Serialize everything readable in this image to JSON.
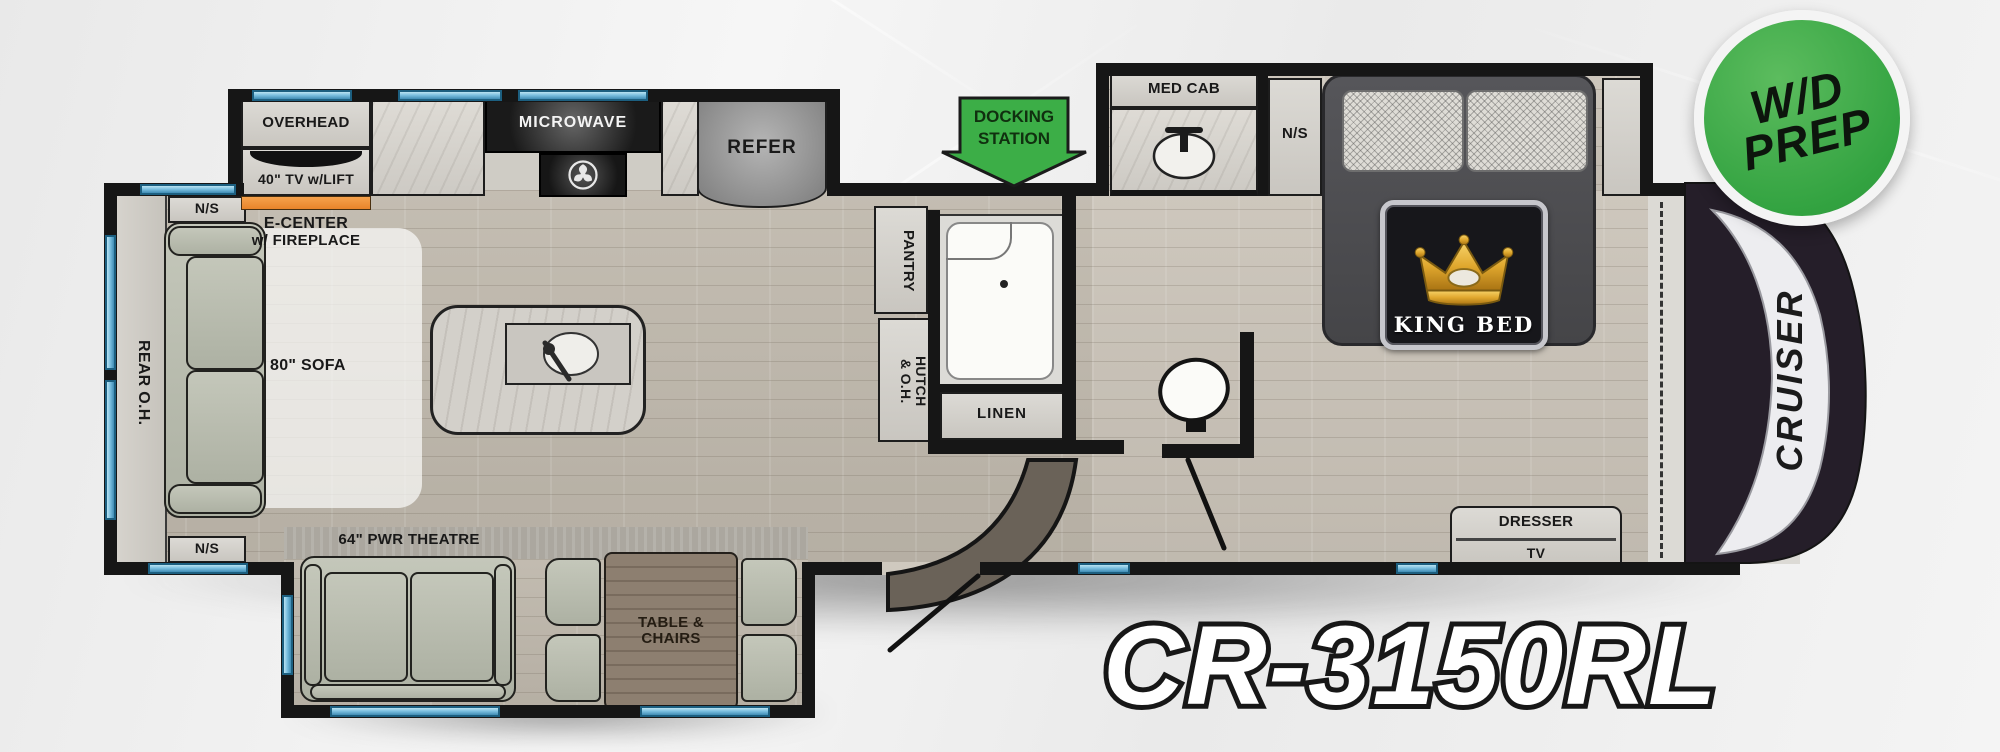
{
  "model": {
    "code": "CR-3150RL",
    "brand_side_label": "CRUISER"
  },
  "badges": {
    "wd_prep_line1": "W/D",
    "wd_prep_line2": "PREP",
    "docking_line1": "DOCKING",
    "docking_line2": "STATION",
    "king_bed": "KING BED"
  },
  "rear_lounge": {
    "nightstand_top": "N/S",
    "rear_overhead": "REAR O.H.",
    "sofa": "80\" SOFA",
    "nightstand_bottom": "N/S",
    "theatre": "64\" PWR THEATRE",
    "table_line1": "TABLE &",
    "table_line2": "CHAIRS"
  },
  "kitchen": {
    "overhead": "OVERHEAD",
    "tv_lift": "40\" TV w/LIFT",
    "ecenter_line1": "E-CENTER",
    "ecenter_line2": "w/ FIREPLACE",
    "microwave": "MICROWAVE",
    "refer": "REFER",
    "pantry": "PANTRY",
    "hutch_line1": "HUTCH",
    "hutch_line2": "& O.H."
  },
  "bathroom": {
    "linen": "LINEN",
    "med_cab": "MED CAB",
    "nightstand": "N/S"
  },
  "bedroom": {
    "dresser": "DRESSER",
    "tv": "TV",
    "washer_dryer": "W/D"
  },
  "colors": {
    "accent_green": "#3cae47",
    "slide_orange": "#ef9133",
    "window_blue": "#7cc0e0",
    "wall_black": "#161616",
    "sofa_sage": "#b9beb0"
  }
}
